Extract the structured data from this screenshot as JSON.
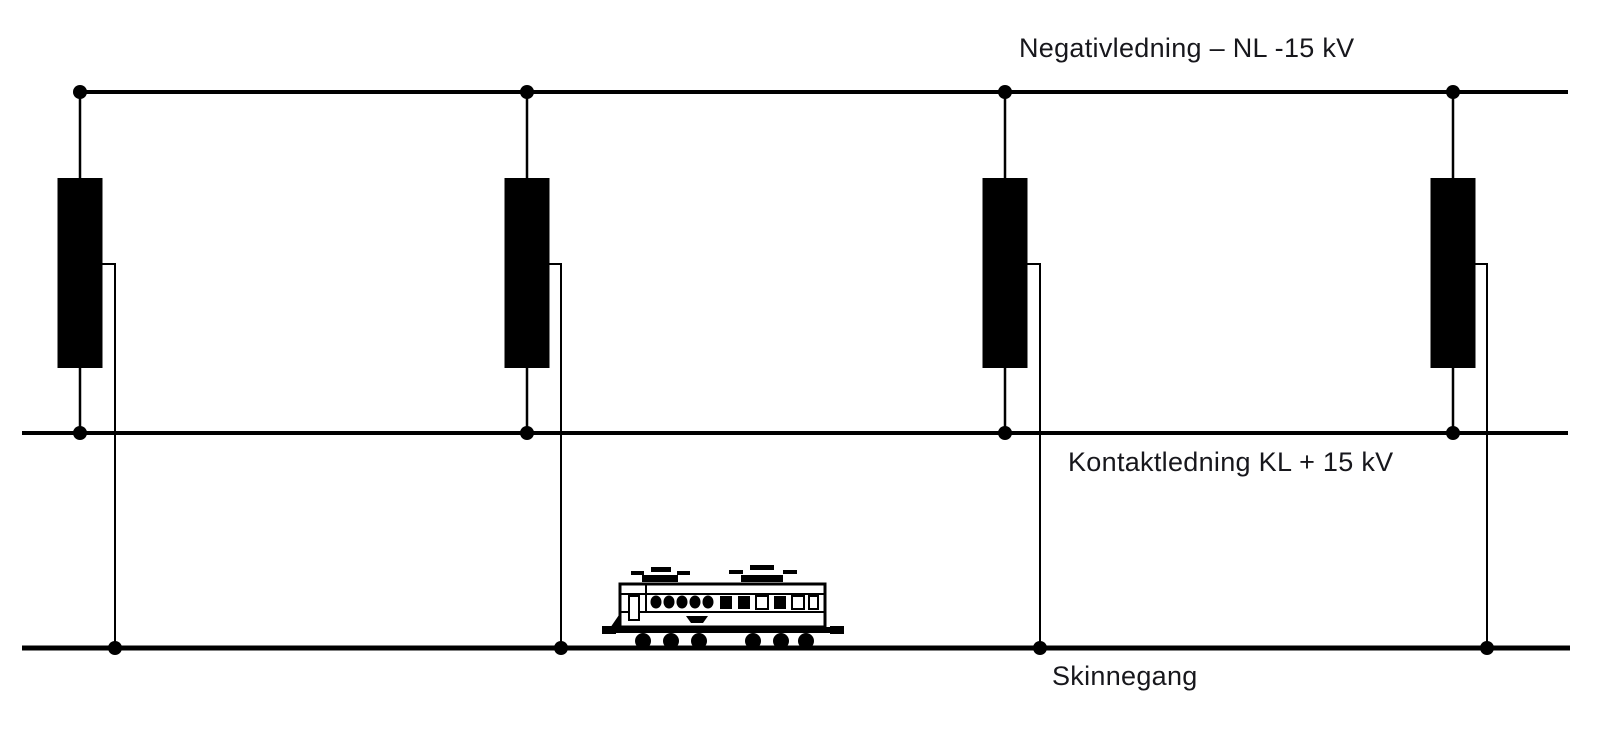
{
  "diagram": {
    "background_color": "#ffffff",
    "line_color": "#000000",
    "text_color": "#17171c",
    "labels": {
      "negative_feeder": "Negativledning – NL -15 kV",
      "contact_line": "Kontaktledning KL + 15 kV",
      "rails": "Skinnegang"
    },
    "conductors": [
      {
        "id": "negative-feeder-line",
        "label": "Negativledning – NL -15 kV",
        "y": 92,
        "x1": 80,
        "x2": 1568,
        "thickness": 4
      },
      {
        "id": "contact-line",
        "label": "Kontaktledning KL + 15 kV",
        "y": 433,
        "x1": 22,
        "x2": 1568,
        "thickness": 4
      },
      {
        "id": "rail-line",
        "label": "Skinnegang",
        "y": 648,
        "x1": 22,
        "x2": 1570,
        "thickness": 5
      }
    ],
    "autotransformers": {
      "count": 4,
      "body_width": 45,
      "body_top_y": 178,
      "body_bottom_y": 368,
      "tap_exit_y": 264,
      "node_radius": 7,
      "lead_thickness": 2.5,
      "tap_thickness": 2,
      "units": [
        {
          "axis_x": 80,
          "tap_x": 115
        },
        {
          "axis_x": 527,
          "tap_x": 561
        },
        {
          "axis_x": 1005,
          "tap_x": 1040
        },
        {
          "axis_x": 1453,
          "tap_x": 1487
        }
      ]
    },
    "train": {
      "present": true,
      "x_left": 602,
      "x_right": 844,
      "on_line": "rail-line"
    }
  }
}
